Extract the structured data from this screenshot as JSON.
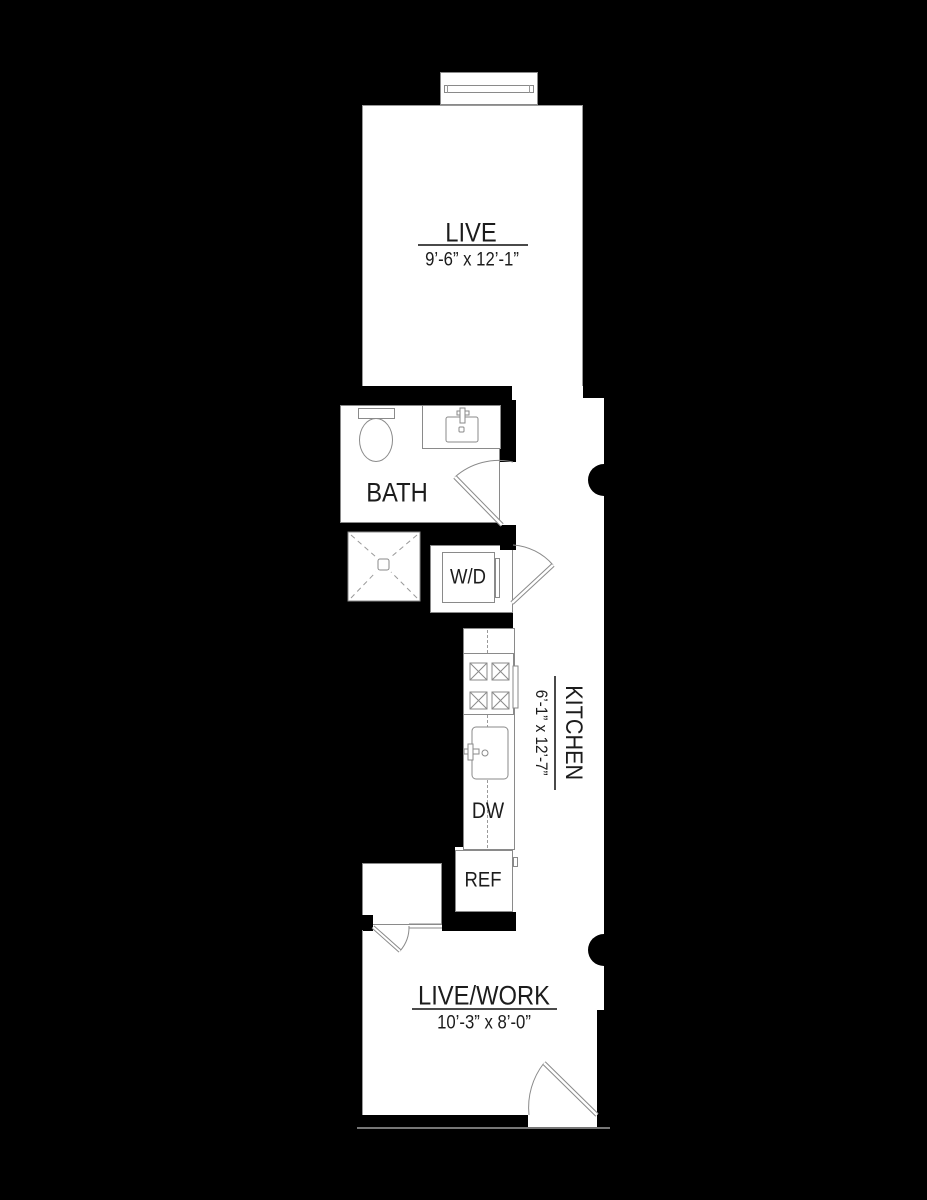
{
  "plan_title": "studio floor plan",
  "rooms": {
    "live": {
      "label": "LIVE",
      "dims": "9’-6” x 12’-1”"
    },
    "bath": {
      "label": "BATH"
    },
    "kitchen": {
      "label": "KITCHEN",
      "dims": "6’-1” x 12’-7”"
    },
    "live_work": {
      "label": "LIVE/WORK",
      "dims": "10’-3” x 8’-0”"
    }
  },
  "appliances": {
    "washer_dryer": {
      "label": "W/D"
    },
    "dishwasher": {
      "label": "DW"
    },
    "refrigerator": {
      "label": "REF"
    }
  },
  "colors": {
    "background": "#000000",
    "floor": "#ffffff",
    "wall": "#000000",
    "fixture_outline": "#8a8a8a",
    "text": "#1c1c1c"
  }
}
